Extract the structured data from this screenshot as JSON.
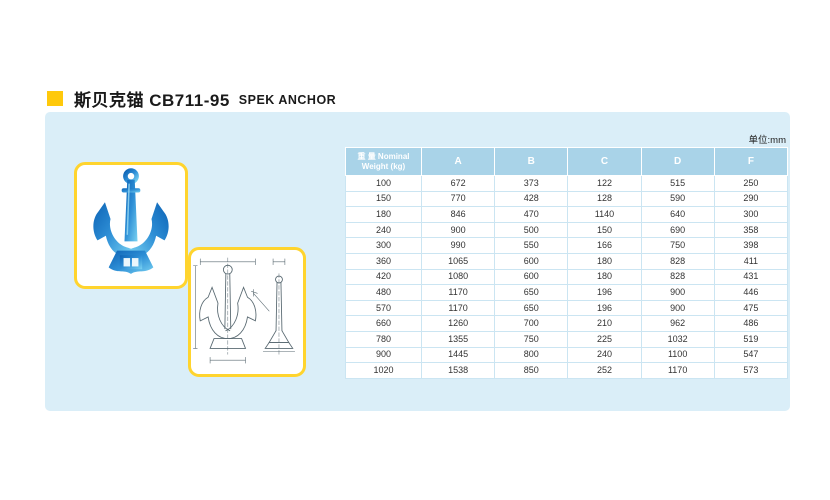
{
  "title": {
    "cn": "斯贝克锚 CB711-95",
    "en": "SPEK ANCHOR"
  },
  "panel": {
    "unit_note": "单位:mm"
  },
  "images": {
    "photo": "spek-anchor-photo",
    "drawing": "spek-anchor-technical-drawing"
  },
  "table": {
    "header": [
      "重 量 Nominal\nWeight (kg)",
      "A",
      "B",
      "C",
      "D",
      "F"
    ],
    "rows": [
      [
        "100",
        "672",
        "373",
        "122",
        "515",
        "250"
      ],
      [
        "150",
        "770",
        "428",
        "128",
        "590",
        "290"
      ],
      [
        "180",
        "846",
        "470",
        "1140",
        "640",
        "300"
      ],
      [
        "240",
        "900",
        "500",
        "150",
        "690",
        "358"
      ],
      [
        "300",
        "990",
        "550",
        "166",
        "750",
        "398"
      ],
      [
        "360",
        "1065",
        "600",
        "180",
        "828",
        "411"
      ],
      [
        "420",
        "1080",
        "600",
        "180",
        "828",
        "431"
      ],
      [
        "480",
        "1170",
        "650",
        "196",
        "900",
        "446"
      ],
      [
        "570",
        "1170",
        "650",
        "196",
        "900",
        "475"
      ],
      [
        "660",
        "1260",
        "700",
        "210",
        "962",
        "486"
      ],
      [
        "780",
        "1355",
        "750",
        "225",
        "1032",
        "519"
      ],
      [
        "900",
        "1445",
        "800",
        "240",
        "1100",
        "547"
      ],
      [
        "1020",
        "1538",
        "850",
        "252",
        "1170",
        "573"
      ]
    ]
  },
  "colors": {
    "accent_yellow": "#FFC90B",
    "panel_blue": "#DAEEF8",
    "header_blue": "#A9D3E8",
    "image_box_yellow": "#FFD42E",
    "anchor_blue": "#2E8FD6"
  }
}
